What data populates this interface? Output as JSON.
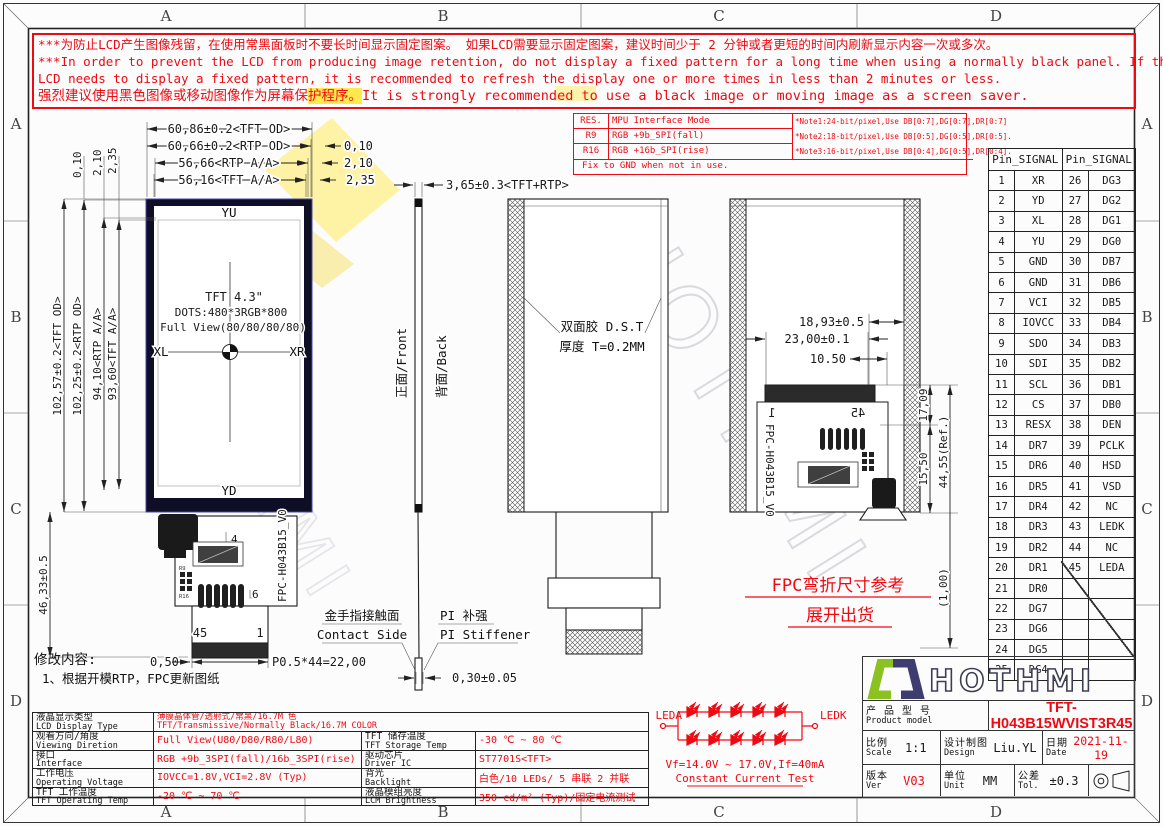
{
  "frame": {
    "zones": [
      "A",
      "B",
      "C",
      "D"
    ]
  },
  "warning": {
    "line1": "***为防止LCD产生图像残留，在使用常黑面板时不要长时间显示固定图案。 如果LCD需要显示固定图案，建议时间少于 2 分钟或者更短的时间内刷新显示内容一次或多次。",
    "line2": "***In order to prevent the LCD from producing image retention, do not display a fixed pattern for a long time when using a normally black panel. If the",
    "line3": "LCD needs to display a fixed pattern, it is recommended to refresh the display one or more times in less than 2 minutes or less.",
    "line4_pre": "强烈建议使用黑色图像或移动图像作为屏幕保",
    "line4_hl": "护程序。",
    "line4_post": "It is strongly recommended to use a black image or moving image as a screen saver."
  },
  "notes": {
    "rows": [
      {
        "key": "RES.",
        "value": "MPU Interface Mode"
      },
      {
        "key": "R9",
        "value": "RGB +9b_SPI(fall)"
      },
      {
        "key": "R16",
        "value": "RGB +16b_SPI(rise)"
      }
    ],
    "notes": [
      "*Note1:24-bit/pixel,Use DB[0:7],DG[0:7],DR[0:7]",
      "*Note2:18-bit/pixel,Use DB[0:5],DG[0:5],DR[0:5].",
      "*Note3:16-bit/pixel,Use DB[0:4],DG[0:5],DR[0:4]."
    ],
    "footer": "Fix to GND  when not in use."
  },
  "pin_table": {
    "header_left": "Pin_SIGNAL",
    "header_right": "Pin_SIGNAL",
    "rows": [
      [
        "1",
        "XR",
        "26",
        "DG3"
      ],
      [
        "2",
        "YD",
        "27",
        "DG2"
      ],
      [
        "3",
        "XL",
        "28",
        "DG1"
      ],
      [
        "4",
        "YU",
        "29",
        "DG0"
      ],
      [
        "5",
        "GND",
        "30",
        "DB7"
      ],
      [
        "6",
        "GND",
        "31",
        "DB6"
      ],
      [
        "7",
        "VCI",
        "32",
        "DB5"
      ],
      [
        "8",
        "IOVCC",
        "33",
        "DB4"
      ],
      [
        "9",
        "SDO",
        "34",
        "DB3"
      ],
      [
        "10",
        "SDI",
        "35",
        "DB2"
      ],
      [
        "11",
        "SCL",
        "36",
        "DB1"
      ],
      [
        "12",
        "CS",
        "37",
        "DB0"
      ],
      [
        "13",
        "RESX",
        "38",
        "DEN"
      ],
      [
        "14",
        "DR7",
        "39",
        "PCLK"
      ],
      [
        "15",
        "DR6",
        "40",
        "HSD"
      ],
      [
        "16",
        "DR5",
        "41",
        "VSD"
      ],
      [
        "17",
        "DR4",
        "42",
        "NC"
      ],
      [
        "18",
        "DR3",
        "43",
        "LEDK"
      ],
      [
        "19",
        "DR2",
        "44",
        "NC"
      ],
      [
        "20",
        "DR1",
        "45",
        "LEDA"
      ],
      [
        "21",
        "DR0",
        "",
        ""
      ],
      [
        "22",
        "DG7",
        "",
        ""
      ],
      [
        "23",
        "DG6",
        "",
        ""
      ],
      [
        "24",
        "DG5",
        "",
        ""
      ],
      [
        "25",
        "DG4",
        "",
        ""
      ]
    ]
  },
  "front": {
    "yu": "YU",
    "yd": "YD",
    "xl": "XL",
    "xr": "XR",
    "c1": "TFT 4.3\"",
    "c2": "DOTS:480*3RGB*800",
    "c3": "Full View(80/80/80/80)"
  },
  "side": {
    "front_label": "正面/Front",
    "back_label": "背面/Back"
  },
  "back": {
    "dst1": "双面胶 D.S.T",
    "dst2": "厚度 T=0.2MM"
  },
  "fpc": {
    "n45": "45",
    "n1": "1",
    "n4": "4",
    "n6": "6",
    "r9": "R9",
    "r16": "R16",
    "name": "FPC-H043B15_V0"
  },
  "contact": {
    "cn": "金手指接触面",
    "en": "Contact Side"
  },
  "stiff": {
    "cn": "PI 补强",
    "en": "PI Stiffener"
  },
  "note_red": {
    "l1": "FPC弯折尺寸参考",
    "l2": "展开出货"
  },
  "rev": {
    "title": "修改内容:",
    "item": "1、根据开模RTP，FPC更新图纸"
  },
  "led": {
    "leda": "LEDA",
    "ledk": "LEDK",
    "vf": "Vf=14.0V ~ 17.0V,If=40mA",
    "test": "Constant Current Test"
  },
  "dims": {
    "w1": "60,86±0.2<TFT OD>",
    "w2": "60,66±0.2<RTP OD>",
    "w3": "56,66<RTP A/A>",
    "w4": "56,16<TFT A/A>",
    "wg1": "0,10",
    "wg2": "2,10",
    "wg3": "2,35",
    "h1": "102,57±0.2<TFT OD>",
    "h2": "102,25±0.2<RTP OD>",
    "h3": "94,10<RTP A/A>",
    "h4": "93,60<TFT A/A>",
    "hg1": "0,10",
    "hg2": "2,10",
    "hg3": "2,35",
    "fpc_len": "46,33±0.5",
    "side_thk": "3,65±0.3<TFT+RTP>",
    "p050": "0,50",
    "pitch": "P0.5*44=22,00",
    "fpc_thk": "0,30±0.05",
    "b1": "18,93±0.5",
    "b2": "23,00±0.1",
    "b3": "10.50",
    "b4": "17,09",
    "b5": "15,50",
    "b6": "44,55(Ref.)",
    "b7": "(1,00)"
  },
  "spec": {
    "r1": {
      "cn": "液晶显示类型",
      "en": "LCD Display Type",
      "v1": "薄膜晶体管/透射式/常黑/16.7M 色",
      "v2": "TFT/Transmissive/Normally Black/16.7M COLOR"
    },
    "r2": {
      "cn": "观看方向/角度",
      "en": "Viewing Diretion",
      "v": "Full View(U80/D80/R80/L80)",
      "cn2": "TFT 储存温度",
      "en2": "TFT Storage Temp",
      "v2": "-30 ℃ ~ 80 ℃"
    },
    "r3": {
      "cn": "接口",
      "en": "Interface",
      "v": "RGB +9b_3SPI(fall)/16b_3SPI(rise)",
      "cn2": "驱动芯片",
      "en2": "Driver IC",
      "v2": "ST7701S<TFT>"
    },
    "r4": {
      "cn": "工作电压",
      "en": "Operating Voltage",
      "v": "IOVCC=1.8V,VCI=2.8V (Typ)",
      "cn2": "背光",
      "en2": "Backlight",
      "v2": "白色/10 LEDs/ 5 串联 2 并联"
    },
    "r5": {
      "cn": "TFT 工作温度",
      "en": "TFT Operating Temp",
      "v": "-20 ℃ ~ 70 ℃",
      "cn2": "液晶模组亮度",
      "en2": "LCM Brightness",
      "v2": "350 cd/m² (Typ)/固定电流测试"
    }
  },
  "tb": {
    "brand": "HOTHMI",
    "product_cn": "产 品 型 号",
    "product_en": "Product model",
    "model": "TFT-H043B15WVIST3R45",
    "scale_cn": "比例",
    "scale_en": "Scale",
    "scale": "1:1",
    "design_cn": "设计制图",
    "design_en": "Design",
    "designer": "Liu.YL",
    "date_cn": "日期",
    "date_en": "Date",
    "date": "2021-11-19",
    "ver_cn": "版本",
    "ver_en": "Ver",
    "ver": "V03",
    "unit_cn": "单位",
    "unit_en": "Unit",
    "unit": "MM",
    "tol_cn": "公差",
    "tol_en": "Tol.",
    "tol": "±0.3"
  },
  "colors": {
    "red": "#ee0a12",
    "line": "#1c1c1c",
    "logo_green": "#8cc122",
    "logo_navy": "#3f3d70"
  }
}
